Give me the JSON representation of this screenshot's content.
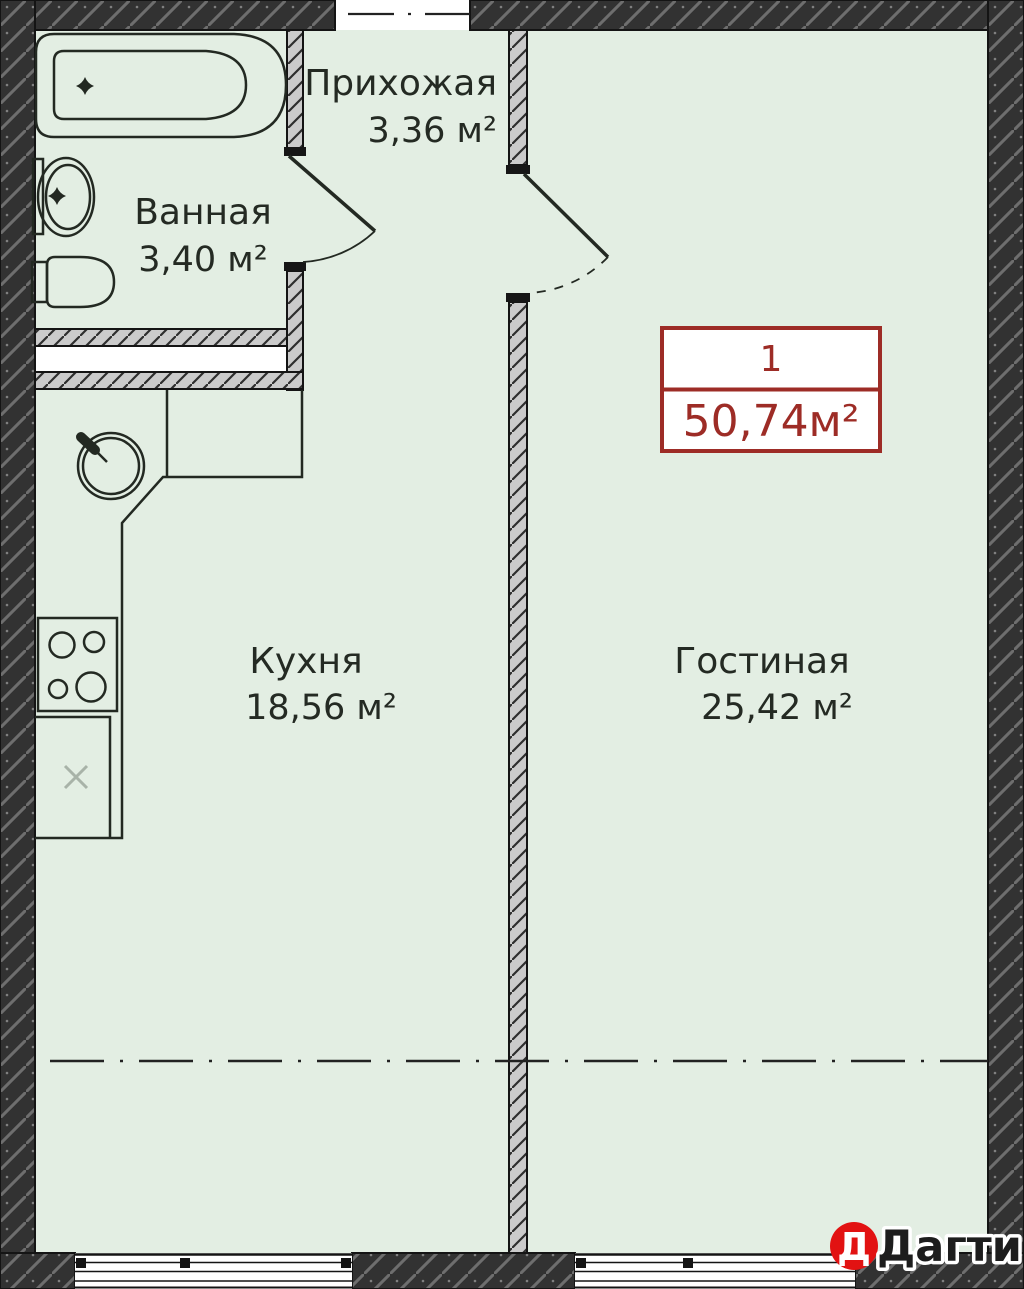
{
  "floor_plan": {
    "rooms": [
      {
        "name": "Прихожая",
        "area": "3,36 м²"
      },
      {
        "name": "Ванная",
        "area": "3,40 м²"
      },
      {
        "name": "Кухня",
        "area": "18,56 м²"
      },
      {
        "name": "Гостиная",
        "area": "25,42 м²"
      }
    ],
    "unit_box": {
      "number": "1",
      "total_area": "50,74м²"
    },
    "watermark": {
      "initial": "Д",
      "brand": "Дагти"
    },
    "colors": {
      "floor": "#e3eee3",
      "wall_dark": "#323232",
      "wall_light": "#cbcbcb",
      "unit_red": "#9d2c26",
      "logo_red": "#e21212",
      "ink": "#242a23"
    }
  }
}
